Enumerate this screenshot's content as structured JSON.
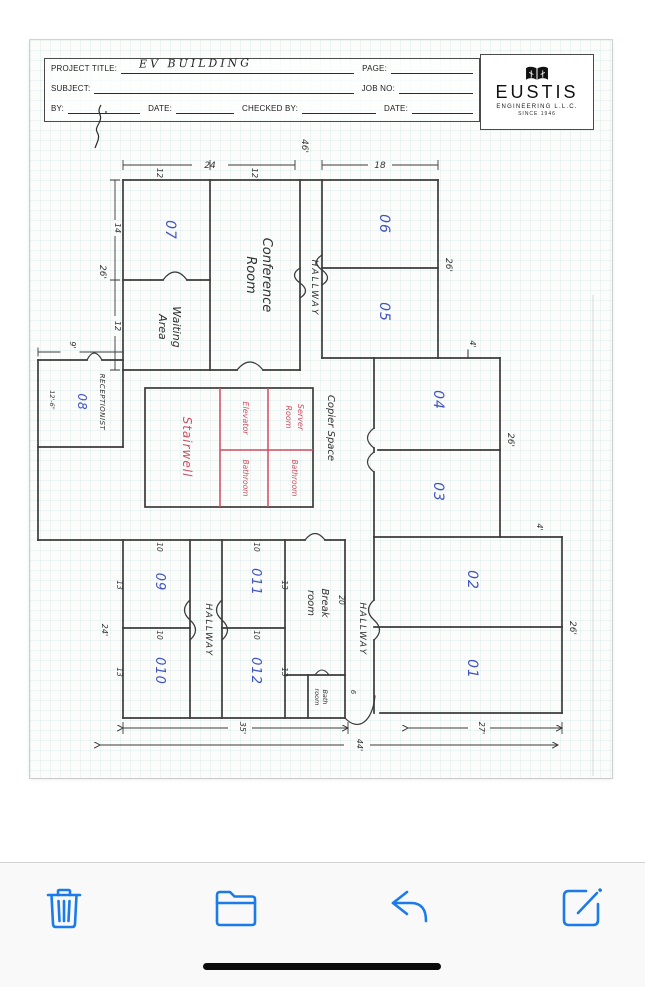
{
  "photo": {
    "title_block": {
      "project_title_label": "PROJECT TITLE:",
      "project_title_value": "EV BUILDING",
      "page_label": "PAGE:",
      "subject_label": "SUBJECT:",
      "job_no_label": "JOB NO:",
      "by_label": "BY:",
      "date_label": "DATE:",
      "checked_by_label": "CHECKED BY:",
      "date2_label": "DATE:"
    },
    "logo": {
      "name": "EUSTIS",
      "subtitle": "ENGINEERING L.L.C.",
      "since": "SINCE 1946"
    }
  },
  "plan": {
    "rooms": {
      "r01": "01",
      "r02": "02",
      "r03": "03",
      "r04": "04",
      "r05": "05",
      "r06": "06",
      "r07": "07",
      "r08": "08",
      "r09": "09",
      "r010": "010",
      "r011": "011",
      "r012": "012"
    },
    "areas": {
      "conference_line1": "Conference",
      "conference_line2": "Room",
      "waiting_line1": "Waiting",
      "waiting_line2": "Area",
      "hallway_top": "HALLWAY",
      "hallway_left": "HALLWAY",
      "hallway_right": "HALLWAY",
      "receptionist": "RECEPTIONIST",
      "stairwell": "Stairwell",
      "elevator": "Elevator",
      "bathroom_a": "Bathroom",
      "bathroom_b": "Bathroom",
      "server_line1": "Server",
      "server_line2": "Room",
      "copier_space": "Copier Space",
      "break_line1": "Break",
      "break_line2": "room",
      "bath_line1": "Bath",
      "bath_line2": "room"
    },
    "dims": {
      "total_top": "46'",
      "top_left": "24",
      "top_left_a": "12",
      "top_left_b": "12",
      "top_right": "18",
      "left_total": "26'",
      "left_a": "14",
      "left_b": "12",
      "recept_w": "9'",
      "recept_h": "12'-6\"",
      "right_0605": "26'",
      "right_0403": "26'",
      "right_0201": "26'",
      "offset_a": "4'",
      "offset_b": "4'",
      "low_left_h": "24'",
      "w10_a": "10",
      "w10_b": "10",
      "w10_c": "10",
      "w10_d": "10",
      "h13_a": "13",
      "h13_b": "13",
      "h13_c": "13",
      "h13_d": "13",
      "break_l": "20",
      "bath_w": "6",
      "bottom_a": "35'",
      "bottom_b": "44'",
      "bottom_c": "27'"
    }
  },
  "toolbar": {
    "icons": [
      "trash-icon",
      "folder-icon",
      "reply-icon",
      "compose-icon"
    ]
  },
  "colors": {
    "ios_blue": "#1b7be8",
    "pen_blue": "#4052c4",
    "marker_red": "#cb4f63",
    "ink": "#3b3b3b"
  }
}
